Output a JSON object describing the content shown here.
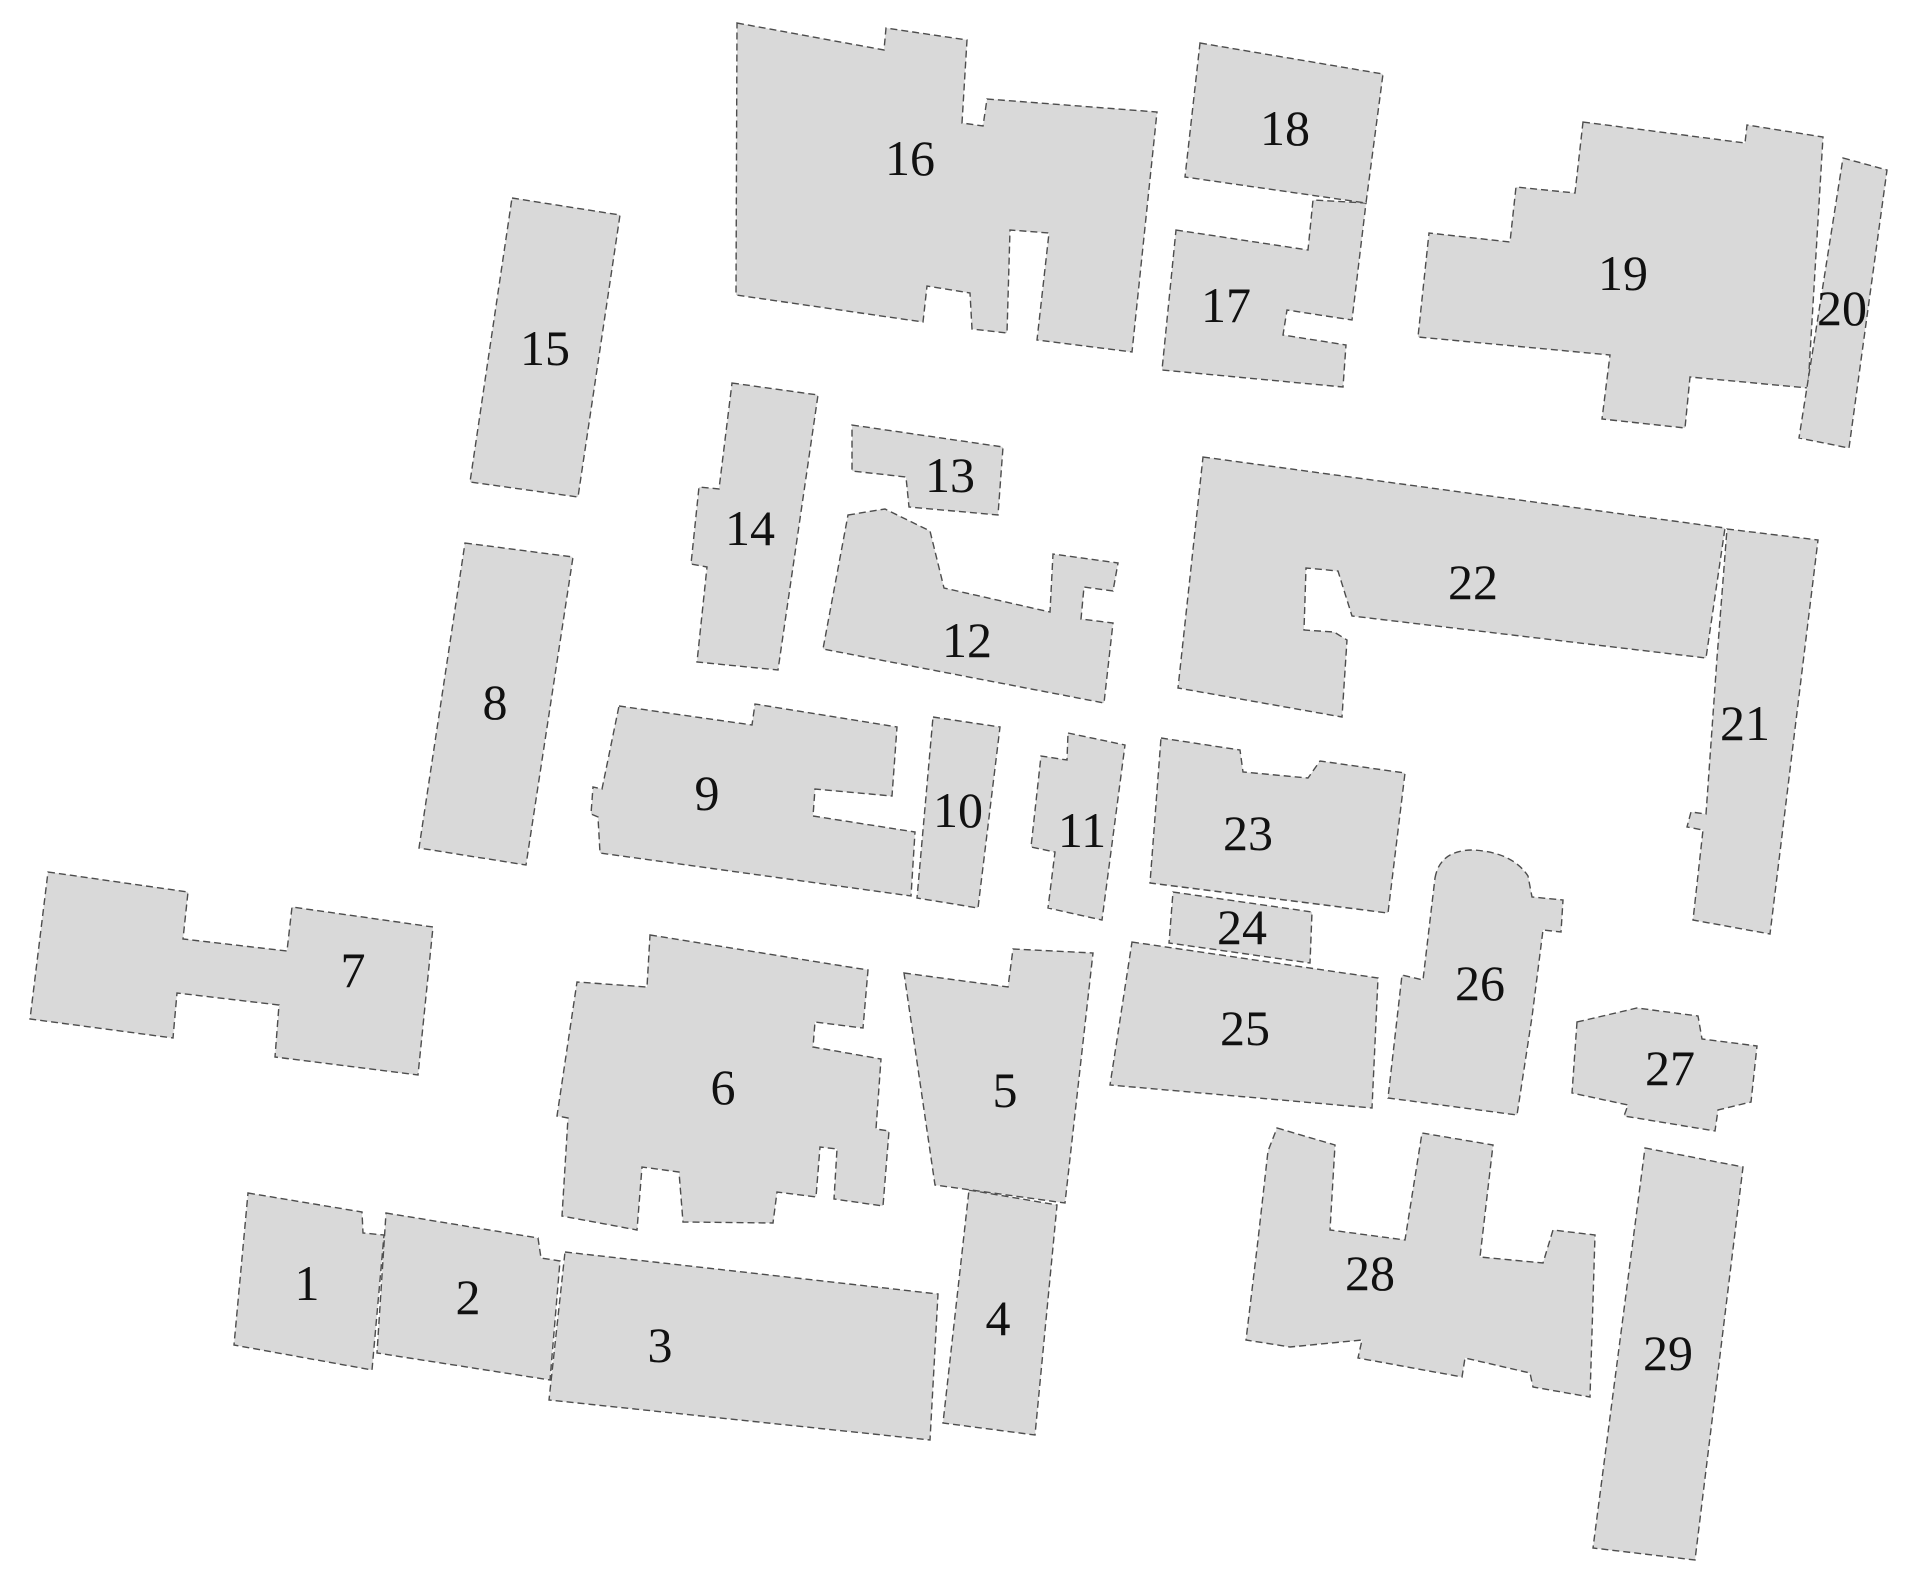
{
  "canvas": {
    "width": 1929,
    "height": 1589,
    "background": "#ffffff"
  },
  "style": {
    "footprint_fill": "#d9d9d9",
    "outline_color": "#4d4d4d",
    "outline_width": 1.4,
    "outline_dash": "7 4",
    "label_color": "#111111"
  },
  "buildings": [
    {
      "id": 1,
      "label": "1",
      "label_x": 307,
      "label_y": 1283,
      "points": [
        [
          248,
          1193
        ],
        [
          362,
          1212
        ],
        [
          363,
          1233
        ],
        [
          384,
          1235
        ],
        [
          372,
          1370
        ],
        [
          234,
          1345
        ]
      ]
    },
    {
      "id": 2,
      "label": "2",
      "label_x": 468,
      "label_y": 1297,
      "points": [
        [
          386,
          1213
        ],
        [
          538,
          1238
        ],
        [
          541,
          1258
        ],
        [
          560,
          1261
        ],
        [
          550,
          1380
        ],
        [
          377,
          1353
        ]
      ]
    },
    {
      "id": 3,
      "label": "3",
      "label_x": 660,
      "label_y": 1345,
      "points": [
        [
          565,
          1252
        ],
        [
          938,
          1294
        ],
        [
          930,
          1440
        ],
        [
          549,
          1400
        ]
      ]
    },
    {
      "id": 4,
      "label": "4",
      "label_x": 998,
      "label_y": 1318,
      "points": [
        [
          969,
          1190
        ],
        [
          1057,
          1205
        ],
        [
          1035,
          1435
        ],
        [
          943,
          1423
        ]
      ]
    },
    {
      "id": 5,
      "label": "5",
      "label_x": 1005,
      "label_y": 1090,
      "points": [
        [
          904,
          973
        ],
        [
          1008,
          987
        ],
        [
          1013,
          949
        ],
        [
          1093,
          953
        ],
        [
          1065,
          1203
        ],
        [
          935,
          1185
        ]
      ]
    },
    {
      "id": 6,
      "label": "6",
      "label_x": 723,
      "label_y": 1087,
      "points": [
        [
          650,
          935
        ],
        [
          868,
          970
        ],
        [
          863,
          1028
        ],
        [
          815,
          1022
        ],
        [
          813,
          1047
        ],
        [
          881,
          1059
        ],
        [
          876,
          1129
        ],
        [
          889,
          1131
        ],
        [
          883,
          1206
        ],
        [
          834,
          1199
        ],
        [
          837,
          1149
        ],
        [
          820,
          1147
        ],
        [
          816,
          1197
        ],
        [
          777,
          1192
        ],
        [
          773,
          1223
        ],
        [
          683,
          1222
        ],
        [
          679,
          1172
        ],
        [
          642,
          1167
        ],
        [
          637,
          1230
        ],
        [
          562,
          1216
        ],
        [
          568,
          1118
        ],
        [
          557,
          1116
        ],
        [
          577,
          982
        ],
        [
          647,
          987
        ]
      ]
    },
    {
      "id": 7,
      "label": "7",
      "label_x": 353,
      "label_y": 970,
      "points": [
        [
          48,
          872
        ],
        [
          188,
          892
        ],
        [
          183,
          939
        ],
        [
          287,
          951
        ],
        [
          292,
          907
        ],
        [
          433,
          927
        ],
        [
          418,
          1075
        ],
        [
          275,
          1057
        ],
        [
          279,
          1005
        ],
        [
          177,
          993
        ],
        [
          173,
          1038
        ],
        [
          30,
          1019
        ]
      ]
    },
    {
      "id": 8,
      "label": "8",
      "label_x": 495,
      "label_y": 702,
      "points": [
        [
          465,
          543
        ],
        [
          573,
          557
        ],
        [
          526,
          865
        ],
        [
          419,
          848
        ]
      ]
    },
    {
      "id": 9,
      "label": "9",
      "label_x": 707,
      "label_y": 793,
      "points": [
        [
          619,
          706
        ],
        [
          752,
          725
        ],
        [
          755,
          704
        ],
        [
          897,
          727
        ],
        [
          892,
          796
        ],
        [
          815,
          789
        ],
        [
          813,
          816
        ],
        [
          915,
          832
        ],
        [
          911,
          896
        ],
        [
          600,
          853
        ],
        [
          598,
          817
        ],
        [
          591,
          814
        ],
        [
          593,
          787
        ],
        [
          602,
          789
        ]
      ]
    },
    {
      "id": 10,
      "label": "10",
      "label_x": 958,
      "label_y": 810,
      "points": [
        [
          933,
          717
        ],
        [
          1000,
          727
        ],
        [
          978,
          908
        ],
        [
          917,
          898
        ]
      ]
    },
    {
      "id": 11,
      "label": "11",
      "label_x": 1082,
      "label_y": 830,
      "points": [
        [
          1068,
          733
        ],
        [
          1125,
          745
        ],
        [
          1102,
          920
        ],
        [
          1048,
          908
        ],
        [
          1055,
          852
        ],
        [
          1031,
          847
        ],
        [
          1041,
          756
        ],
        [
          1067,
          760
        ]
      ]
    },
    {
      "id": 12,
      "label": "12",
      "label_x": 967,
      "label_y": 640,
      "points": [
        [
          848,
          515
        ],
        [
          885,
          509
        ],
        [
          930,
          531
        ],
        [
          944,
          588
        ],
        [
          1050,
          612
        ],
        [
          1053,
          554
        ],
        [
          1118,
          563
        ],
        [
          1113,
          591
        ],
        [
          1084,
          587
        ],
        [
          1081,
          619
        ],
        [
          1113,
          623
        ],
        [
          1104,
          703
        ],
        [
          823,
          649
        ]
      ]
    },
    {
      "id": 13,
      "label": "13",
      "label_x": 950,
      "label_y": 475,
      "points": [
        [
          852,
          425
        ],
        [
          1003,
          447
        ],
        [
          998,
          515
        ],
        [
          909,
          507
        ],
        [
          906,
          477
        ],
        [
          852,
          471
        ]
      ]
    },
    {
      "id": 14,
      "label": "14",
      "label_x": 750,
      "label_y": 528,
      "points": [
        [
          732,
          383
        ],
        [
          818,
          395
        ],
        [
          778,
          670
        ],
        [
          697,
          662
        ],
        [
          707,
          567
        ],
        [
          691,
          564
        ],
        [
          699,
          487
        ],
        [
          719,
          489
        ]
      ]
    },
    {
      "id": 15,
      "label": "15",
      "label_x": 545,
      "label_y": 348,
      "points": [
        [
          512,
          198
        ],
        [
          620,
          215
        ],
        [
          578,
          497
        ],
        [
          470,
          482
        ]
      ]
    },
    {
      "id": 16,
      "label": "16",
      "label_x": 910,
      "label_y": 158,
      "points": [
        [
          737,
          23
        ],
        [
          884,
          50
        ],
        [
          886,
          28
        ],
        [
          967,
          40
        ],
        [
          962,
          123
        ],
        [
          983,
          126
        ],
        [
          987,
          99
        ],
        [
          1157,
          112
        ],
        [
          1132,
          352
        ],
        [
          1037,
          340
        ],
        [
          1049,
          233
        ],
        [
          1010,
          230
        ],
        [
          1007,
          333
        ],
        [
          972,
          329
        ],
        [
          970,
          293
        ],
        [
          927,
          286
        ],
        [
          923,
          322
        ],
        [
          736,
          295
        ]
      ]
    },
    {
      "id": 17,
      "label": "17",
      "label_x": 1226,
      "label_y": 305,
      "points": [
        [
          1176,
          230
        ],
        [
          1308,
          250
        ],
        [
          1313,
          200
        ],
        [
          1366,
          203
        ],
        [
          1352,
          320
        ],
        [
          1287,
          310
        ],
        [
          1283,
          335
        ],
        [
          1346,
          345
        ],
        [
          1343,
          387
        ],
        [
          1162,
          370
        ]
      ]
    },
    {
      "id": 18,
      "label": "18",
      "label_x": 1285,
      "label_y": 128,
      "points": [
        [
          1200,
          43
        ],
        [
          1383,
          74
        ],
        [
          1366,
          203
        ],
        [
          1185,
          177
        ]
      ]
    },
    {
      "id": 19,
      "label": "19",
      "label_x": 1623,
      "label_y": 273,
      "points": [
        [
          1583,
          122
        ],
        [
          1745,
          143
        ],
        [
          1747,
          125
        ],
        [
          1823,
          137
        ],
        [
          1808,
          388
        ],
        [
          1690,
          377
        ],
        [
          1685,
          428
        ],
        [
          1602,
          419
        ],
        [
          1610,
          355
        ],
        [
          1418,
          337
        ],
        [
          1429,
          233
        ],
        [
          1510,
          242
        ],
        [
          1516,
          187
        ],
        [
          1575,
          193
        ]
      ]
    },
    {
      "id": 20,
      "label": "20",
      "label_x": 1842,
      "label_y": 308,
      "points": [
        [
          1843,
          158
        ],
        [
          1887,
          170
        ],
        [
          1849,
          448
        ],
        [
          1799,
          438
        ]
      ]
    },
    {
      "id": 21,
      "label": "21",
      "label_x": 1745,
      "label_y": 723,
      "points": [
        [
          1727,
          529
        ],
        [
          1818,
          540
        ],
        [
          1770,
          934
        ],
        [
          1693,
          920
        ],
        [
          1703,
          830
        ],
        [
          1687,
          827
        ],
        [
          1691,
          812
        ],
        [
          1706,
          814
        ],
        [
          1717,
          658
        ]
      ]
    },
    {
      "id": 22,
      "label": "22",
      "label_x": 1473,
      "label_y": 582,
      "points": [
        [
          1203,
          457
        ],
        [
          1725,
          528
        ],
        [
          1706,
          658
        ],
        [
          1352,
          616
        ],
        [
          1338,
          571
        ],
        [
          1306,
          568
        ],
        [
          1304,
          630
        ],
        [
          1334,
          632
        ],
        [
          1347,
          640
        ],
        [
          1342,
          717
        ],
        [
          1178,
          688
        ]
      ]
    },
    {
      "id": 23,
      "label": "23",
      "label_x": 1248,
      "label_y": 833,
      "points": [
        [
          1161,
          738
        ],
        [
          1240,
          750
        ],
        [
          1243,
          772
        ],
        [
          1308,
          778
        ],
        [
          1320,
          761
        ],
        [
          1405,
          773
        ],
        [
          1388,
          913
        ],
        [
          1150,
          883
        ]
      ]
    },
    {
      "id": 24,
      "label": "24",
      "label_x": 1242,
      "label_y": 927,
      "points": [
        [
          1173,
          892
        ],
        [
          1312,
          912
        ],
        [
          1310,
          963
        ],
        [
          1169,
          943
        ]
      ]
    },
    {
      "id": 25,
      "label": "25",
      "label_x": 1245,
      "label_y": 1028,
      "points": [
        [
          1132,
          942
        ],
        [
          1378,
          978
        ],
        [
          1372,
          1108
        ],
        [
          1110,
          1085
        ]
      ]
    },
    {
      "id": 26,
      "label": "26",
      "label_x": 1480,
      "label_y": 983,
      "path": "M1435,878 Q1440,850 1473,850 Q1512,852 1528,876 L1532,897 L1563,900 L1561,932 L1543,930 L1532,1017 L1517,1115 L1388,1098 L1402,975 L1423,980 Z"
    },
    {
      "id": 27,
      "label": "27",
      "label_x": 1670,
      "label_y": 1068,
      "points": [
        [
          1577,
          1022
        ],
        [
          1637,
          1008
        ],
        [
          1698,
          1016
        ],
        [
          1702,
          1039
        ],
        [
          1757,
          1046
        ],
        [
          1751,
          1102
        ],
        [
          1718,
          1110
        ],
        [
          1715,
          1131
        ],
        [
          1624,
          1116
        ],
        [
          1628,
          1105
        ],
        [
          1572,
          1093
        ]
      ]
    },
    {
      "id": 28,
      "label": "28",
      "label_x": 1370,
      "label_y": 1273,
      "points": [
        [
          1277,
          1128
        ],
        [
          1335,
          1145
        ],
        [
          1330,
          1230
        ],
        [
          1405,
          1240
        ],
        [
          1422,
          1133
        ],
        [
          1493,
          1145
        ],
        [
          1480,
          1257
        ],
        [
          1543,
          1263
        ],
        [
          1553,
          1230
        ],
        [
          1595,
          1235
        ],
        [
          1590,
          1397
        ],
        [
          1533,
          1387
        ],
        [
          1530,
          1373
        ],
        [
          1465,
          1358
        ],
        [
          1462,
          1377
        ],
        [
          1358,
          1358
        ],
        [
          1362,
          1340
        ],
        [
          1290,
          1347
        ],
        [
          1246,
          1340
        ],
        [
          1258,
          1240
        ],
        [
          1268,
          1151
        ]
      ]
    },
    {
      "id": 29,
      "label": "29",
      "label_x": 1668,
      "label_y": 1353,
      "points": [
        [
          1645,
          1148
        ],
        [
          1743,
          1167
        ],
        [
          1695,
          1560
        ],
        [
          1593,
          1548
        ]
      ]
    }
  ]
}
